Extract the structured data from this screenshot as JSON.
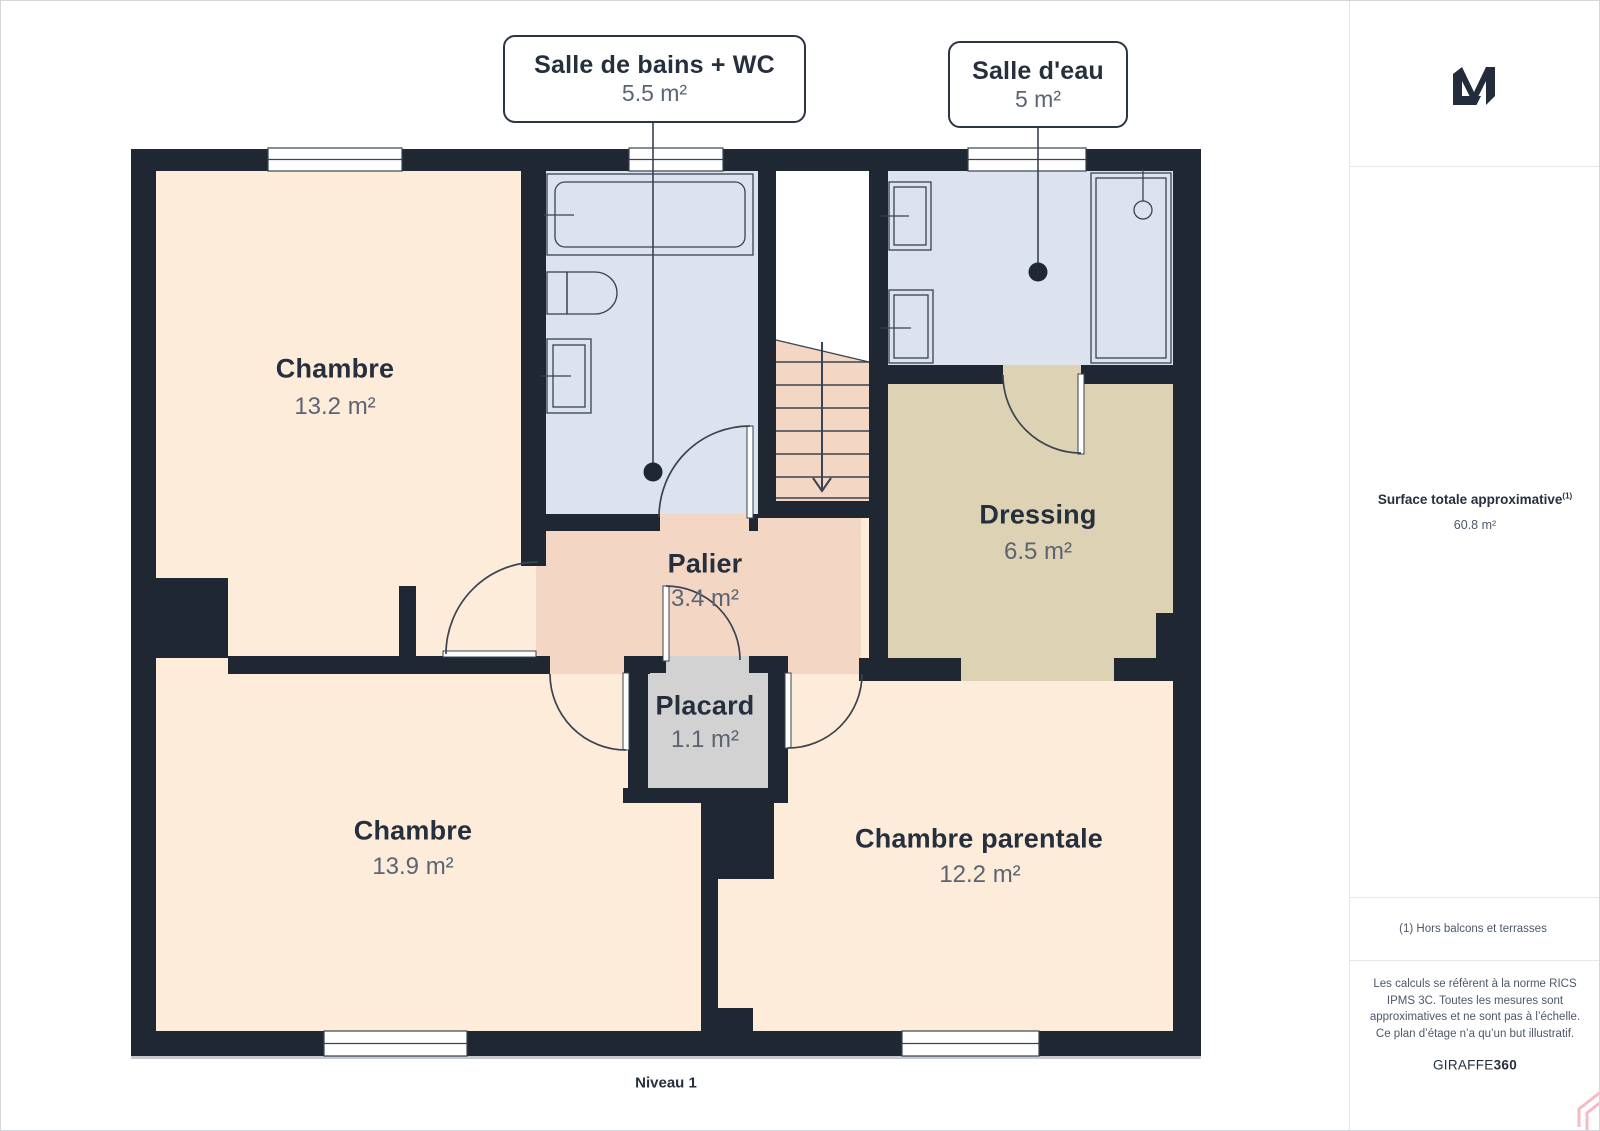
{
  "plan": {
    "level_label": "Niveau 1",
    "total_rooms_note": "floor plan of level 1",
    "callouts": [
      {
        "name": "Salle de bains + WC",
        "area": "5.5 m²"
      },
      {
        "name": "Salle d'eau",
        "area": "5 m²"
      }
    ],
    "rooms": [
      {
        "name": "Chambre",
        "area": "13.2 m²"
      },
      {
        "name": "Palier",
        "area": "3.4 m²"
      },
      {
        "name": "Placard",
        "area": "1.1 m²"
      },
      {
        "name": "Dressing",
        "area": "6.5 m²"
      },
      {
        "name": "Chambre",
        "area": "13.9 m²"
      },
      {
        "name": "Chambre parentale",
        "area": "12.2 m²"
      }
    ],
    "colors": {
      "wall": "#1f2732",
      "bedroom_floor": "#fcecd9",
      "bathroom_floor": "#dce2ee",
      "dressing_floor": "#ddd2b3",
      "landing_floor": "#f3d7c4",
      "closet_floor": "#d2d2d3",
      "label_dark": "#262f3e",
      "label_gray": "#5a6473",
      "watermark_pink": "#f5bac4"
    }
  },
  "sidebar": {
    "surface_title": "Surface totale approximative",
    "surface_sup": "(1)",
    "surface_value": "60.8 m²",
    "footnote": "(1) Hors balcons et terrasses",
    "disclaimer": "Les calculs se réfèrent à la norme RICS IPMS 3C. Toutes les mesures sont approximatives et ne sont pas à l’échelle. Ce plan d’étage n’a qu’un but illustratif.",
    "brand": "GIRAFFE",
    "brand_suffix": "360"
  }
}
